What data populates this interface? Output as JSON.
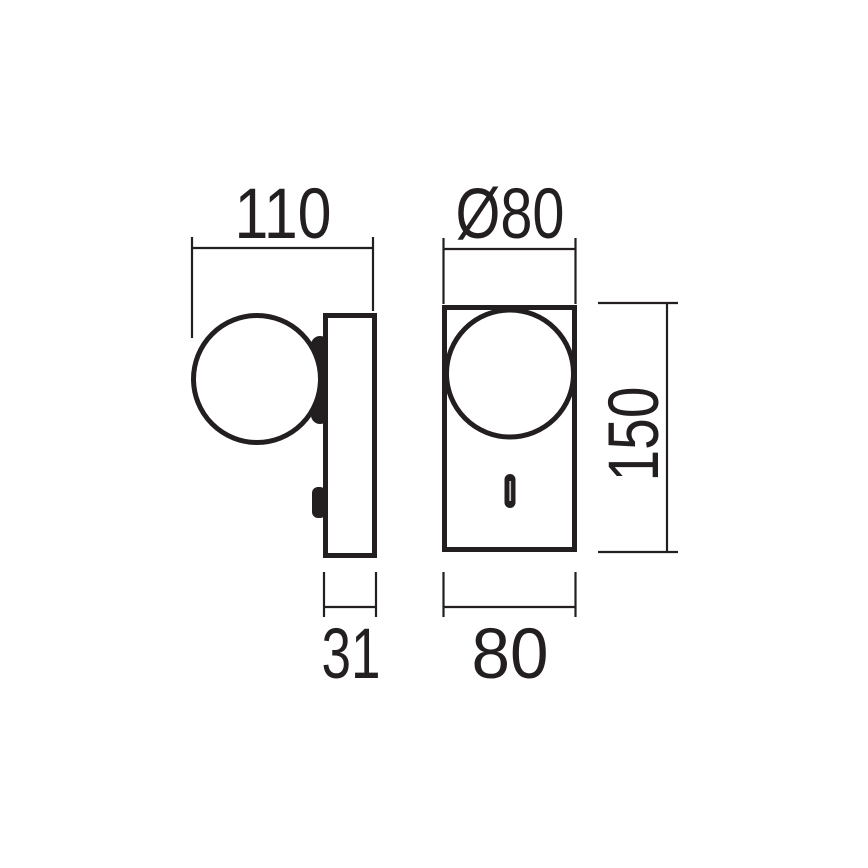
{
  "colors": {
    "background": "#ffffff",
    "line": "#231f20"
  },
  "dimensions": {
    "overall_depth_with_sphere": {
      "label": "110"
    },
    "sphere_diameter": {
      "label": "Ø80"
    },
    "body_height": {
      "label": "150"
    },
    "body_depth": {
      "label": "31"
    },
    "body_width": {
      "label": "80"
    }
  }
}
